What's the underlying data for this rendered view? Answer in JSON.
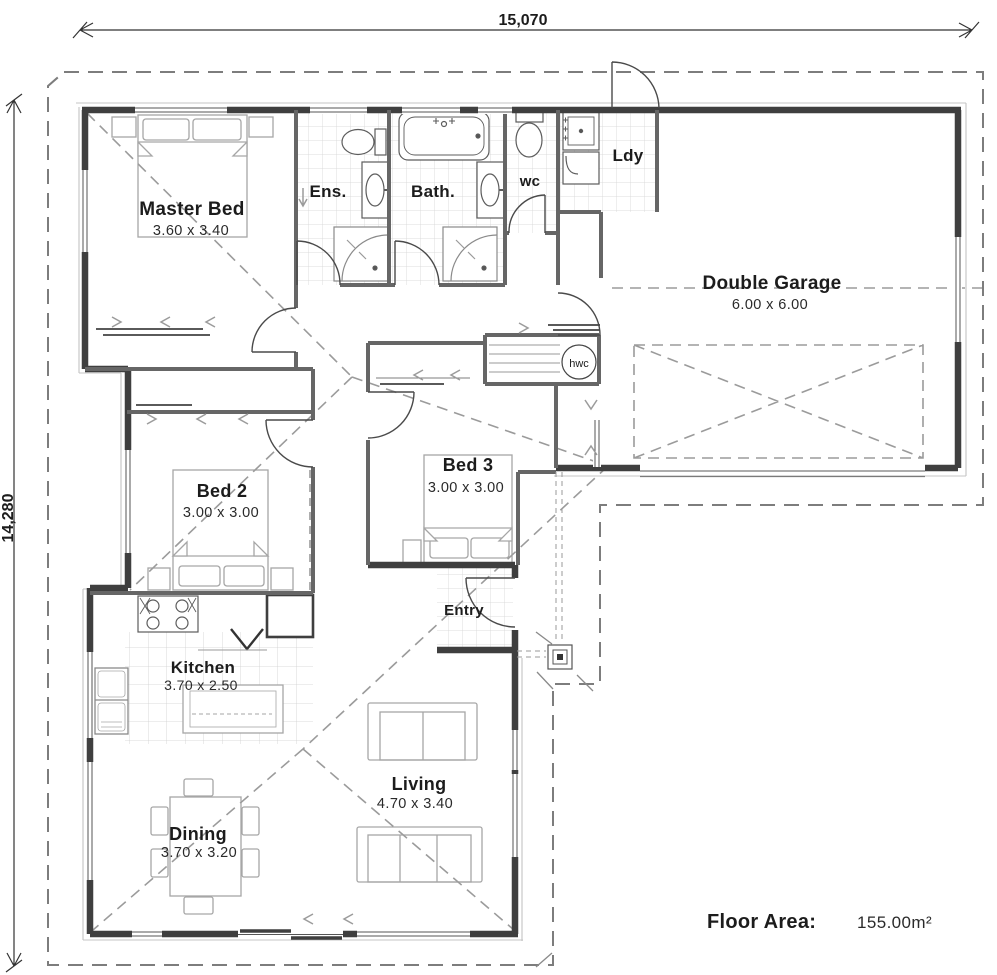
{
  "dimensions": {
    "top": "15,070",
    "left": "14,280"
  },
  "rooms": {
    "master": {
      "name": "Master Bed",
      "size": "3.60 x 3.40"
    },
    "ensuite": {
      "name": "Ens."
    },
    "bath": {
      "name": "Bath."
    },
    "wc": {
      "name": "wc"
    },
    "laundry": {
      "name": "Ldy"
    },
    "garage": {
      "name": "Double Garage",
      "size": "6.00 x 6.00"
    },
    "bed2": {
      "name": "Bed 2",
      "size": "3.00 x 3.00"
    },
    "bed3": {
      "name": "Bed 3",
      "size": "3.00 x 3.00"
    },
    "entry": {
      "name": "Entry"
    },
    "kitchen": {
      "name": "Kitchen",
      "size": "3.70 x 2.50"
    },
    "living": {
      "name": "Living",
      "size": "4.70 x 3.40"
    },
    "dining": {
      "name": "Dining",
      "size": "3.70 x 3.20"
    }
  },
  "fixtures": {
    "hot_water_cylinder": "hwc"
  },
  "floor_area": {
    "label": "Floor Area:",
    "value": "155.00m²"
  },
  "colors": {
    "wall": "#3f3f3f",
    "interior_wall": "#666666",
    "eave_dash": "#7d7d7d",
    "roof_dash": "#9b9b9b",
    "tile": "#d2d2d2",
    "furniture": "#a6a6a6",
    "text": "#1c1c1c"
  }
}
